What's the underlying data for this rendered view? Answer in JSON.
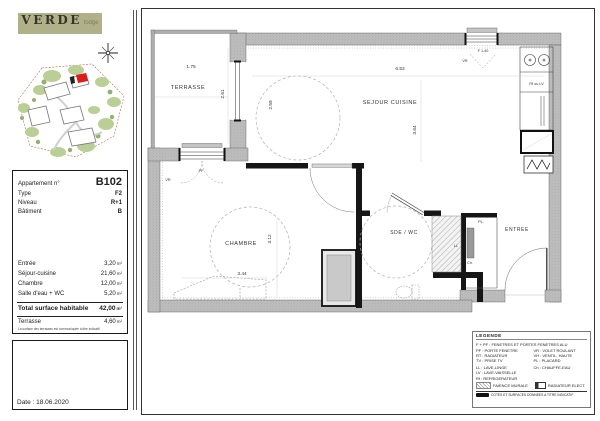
{
  "sidebar": {
    "logo": {
      "brand": "VERDE",
      "suffix": "lodge"
    },
    "info": {
      "apartment_label": "Appartement n°",
      "apartment_value": "B102",
      "type_label": "Type",
      "type_value": "F2",
      "level_label": "Niveau",
      "level_value": "R+1",
      "building_label": "Bâtiment",
      "building_value": "B"
    },
    "areas": {
      "unit": "m²",
      "rows": [
        {
          "label": "Entrée",
          "value": "3,20"
        },
        {
          "label": "Séjour-cuisine",
          "value": "21,60"
        },
        {
          "label": "Chambre",
          "value": "12,00"
        },
        {
          "label": "Salle d'eau + WC",
          "value": "5,20"
        }
      ],
      "total_label": "Total surface habitable",
      "total_value": "42,00",
      "terrace_label": "Terrasse",
      "terrace_value": "4,60",
      "note": "La surface des terrasses est communiquée à titre indicatif"
    },
    "date": "Date : 18.06.2020"
  },
  "plan": {
    "rooms": {
      "terrasse": "TERRASSE",
      "sejour": "SEJOUR CUISINE",
      "chambre": "CHAMBRE",
      "sde": "SDE / WC",
      "entree": "ENTREE",
      "placard": "PL."
    },
    "dims": {
      "terrasse_w": "1.75",
      "terrasse_h": "2.61",
      "sejour_left": "2.59",
      "sejour_w": "6.53",
      "sejour_h": "3.64",
      "chambre_h": "3.12",
      "chambre_w": "3.44"
    },
    "labels": {
      "window": "F 1.40",
      "vr_top": "VR",
      "pf": "PF",
      "vr_terrace": "VR",
      "rf_lv": "Rf ou LV",
      "ll": "LL",
      "ch": "Ch."
    }
  },
  "legend": {
    "title": "LEGENDE",
    "line1": "F + PF : FENETRES ET PORTES FENETRES ALU",
    "col1": [
      "PF : PORTE FENETRE",
      "RT : RADIATEUR",
      "TV : PRISE TV"
    ],
    "col2": [
      "VR : VOLET ROULANT",
      "VH : VENTIL. HAUTE",
      "PL : PLACARD"
    ],
    "col3": [
      "LL : LAVE-LINGE",
      "LV : LAVE-VAISSELLE",
      "Rf : REFRIGERATEUR"
    ],
    "col4": [
      "Ch : CHAUFFE-EAU"
    ],
    "symbols": [
      {
        "label": "FAIENCE MURALE"
      },
      {
        "label": "RADIATEUR ELECT."
      }
    ],
    "note": "COTES ET SURFACES DONNEES A TITRE INDICATIF"
  }
}
